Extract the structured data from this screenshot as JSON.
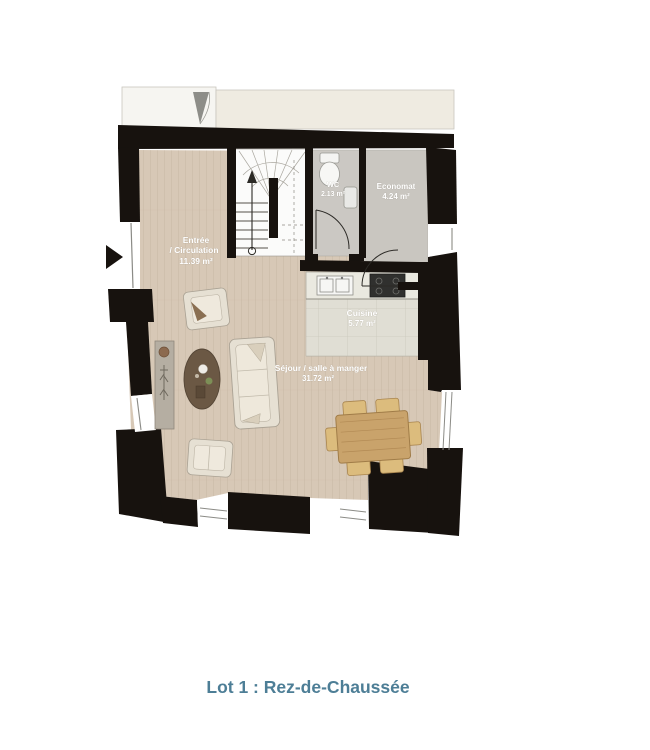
{
  "plan": {
    "rooms": {
      "entree": {
        "line1": "Entrée",
        "line2": "/ Circulation",
        "area": "11.39 m²"
      },
      "wc": {
        "name": "WC",
        "area": "2.13 m²"
      },
      "economat": {
        "name": "Economat",
        "area": "4.24 m²"
      },
      "cuisine": {
        "name": "Cuisine",
        "area": "5.77 m²"
      },
      "sejour": {
        "name": "Séjour / salle à manger",
        "area": "31.72 m²"
      }
    }
  },
  "caption": "Lot 1 : Rez-de-Chaussée",
  "colors": {
    "wall": "#17120e",
    "wood_floor": "#d7c8b6",
    "gray_floor": "#c9c6c0",
    "tile_floor": "#e0ded4",
    "counter": "#eae9e0",
    "terrace": "#efebe1",
    "caption_text": "#4d7e96",
    "furniture_fabric": "#e6e0d3",
    "table_wood": "#c9a36b",
    "coffee_table": "#6b5844"
  }
}
